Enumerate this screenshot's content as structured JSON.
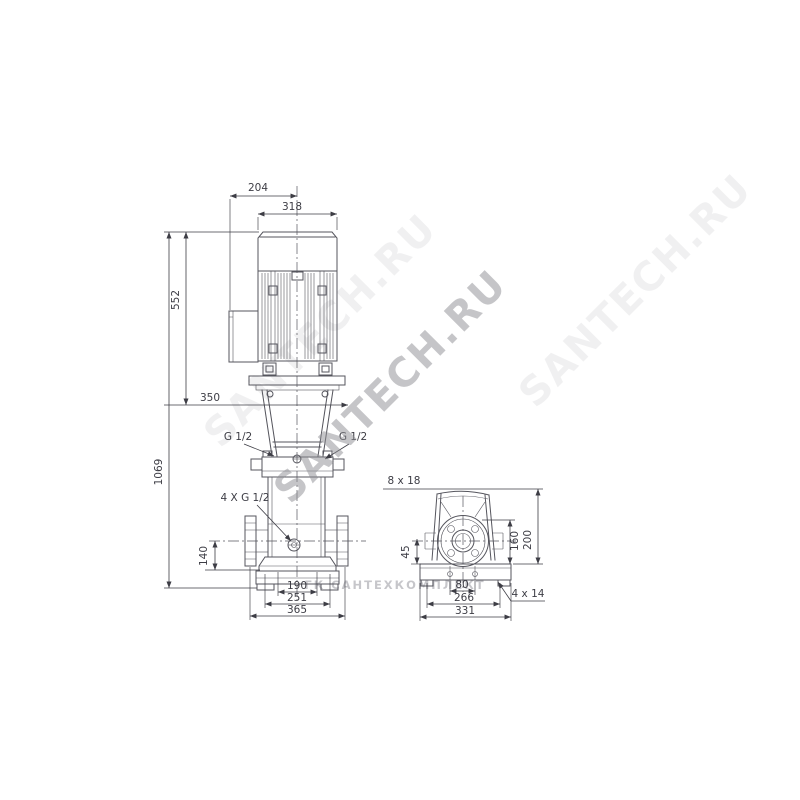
{
  "front_view": {
    "dim_top_offset": "204",
    "dim_motor_width": "318",
    "dim_motor_height": "552",
    "dim_mid": "350",
    "dim_total_height": "1069",
    "port_left": "G 1/2",
    "port_right": "G 1/2",
    "drain_ports": "4 X G 1/2",
    "dim_port_height": "140",
    "dim_base_inner": "190",
    "dim_base_mid": "251",
    "dim_base_outer": "365"
  },
  "side_view": {
    "slot_label": "8 x 18",
    "dim_port_center": "45",
    "dim_height_160": "160",
    "dim_height_200": "200",
    "dim_bolt_spacing": "80",
    "dim_base_mid": "266",
    "dim_base_outer": "331",
    "hole_label": "4 x 14"
  },
  "watermarks": {
    "main": "SANTECH.RU",
    "bottom": "ГК САНТЕХКОМПЛЕКТ"
  },
  "colors": {
    "line": "#55555d",
    "dim": "#3d3d45",
    "watermark": "#8d8d92"
  }
}
